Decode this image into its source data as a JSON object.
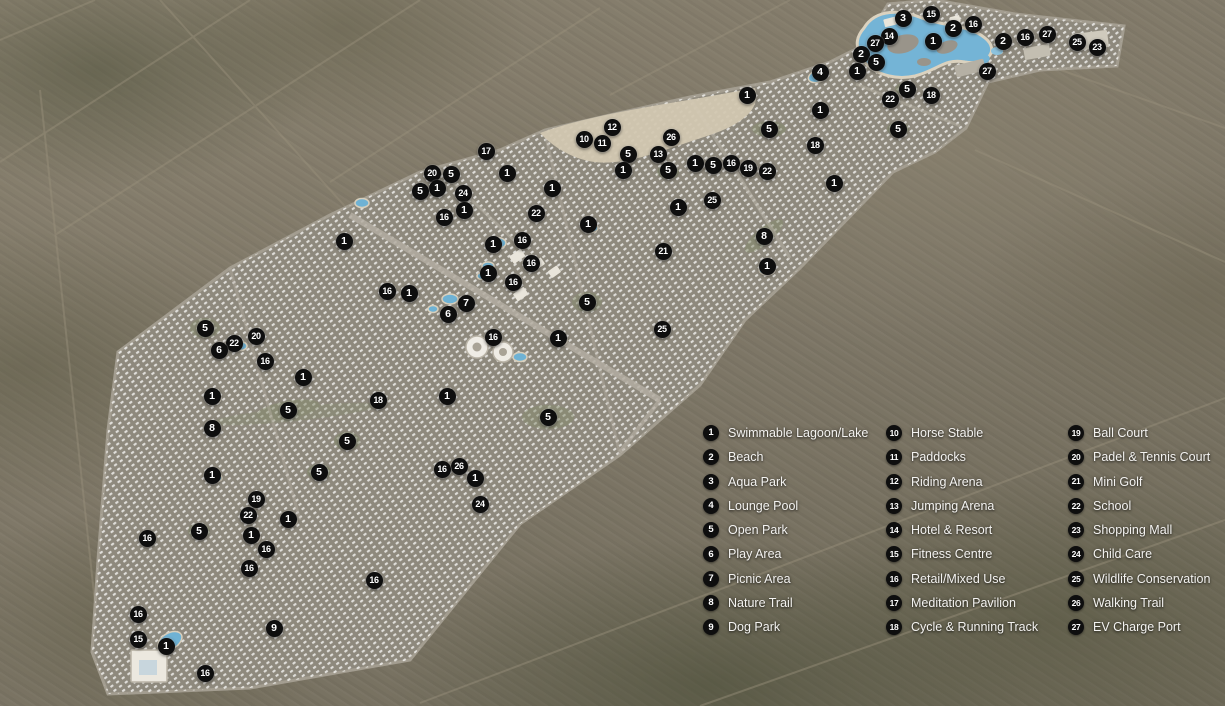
{
  "theme": {
    "marker_bg": "#0e0e0e",
    "marker_text": "#ffffff",
    "lagoon_blue": "#74b4d6",
    "sand_beige": "#d2c7b1",
    "site_gray": "#8e897d",
    "desert_brown": "#827a69"
  },
  "legend": {
    "columns": [
      {
        "items": [
          {
            "num": "1",
            "label": "Swimmable Lagoon/Lake"
          },
          {
            "num": "2",
            "label": "Beach"
          },
          {
            "num": "3",
            "label": "Aqua Park"
          },
          {
            "num": "4",
            "label": "Lounge Pool"
          },
          {
            "num": "5",
            "label": "Open Park"
          },
          {
            "num": "6",
            "label": "Play Area"
          },
          {
            "num": "7",
            "label": "Picnic Area"
          },
          {
            "num": "8",
            "label": "Nature Trail"
          },
          {
            "num": "9",
            "label": "Dog Park"
          }
        ]
      },
      {
        "items": [
          {
            "num": "10",
            "label": "Horse Stable"
          },
          {
            "num": "11",
            "label": "Paddocks"
          },
          {
            "num": "12",
            "label": "Riding Arena"
          },
          {
            "num": "13",
            "label": "Jumping Arena"
          },
          {
            "num": "14",
            "label": "Hotel & Resort"
          },
          {
            "num": "15",
            "label": "Fitness Centre"
          },
          {
            "num": "16",
            "label": "Retail/Mixed Use"
          },
          {
            "num": "17",
            "label": "Meditation Pavilion"
          },
          {
            "num": "18",
            "label": "Cycle & Running Track"
          }
        ]
      },
      {
        "items": [
          {
            "num": "19",
            "label": "Ball Court"
          },
          {
            "num": "20",
            "label": "Padel & Tennis Court"
          },
          {
            "num": "21",
            "label": "Mini Golf"
          },
          {
            "num": "22",
            "label": "School"
          },
          {
            "num": "23",
            "label": "Shopping Mall"
          },
          {
            "num": "24",
            "label": "Child Care"
          },
          {
            "num": "25",
            "label": "Wildlife Conservation"
          },
          {
            "num": "26",
            "label": "Walking Trail"
          },
          {
            "num": "27",
            "label": "EV Charge Port"
          }
        ]
      }
    ]
  },
  "map": {
    "markers": [
      {
        "n": "15",
        "x": 931,
        "y": 14
      },
      {
        "n": "3",
        "x": 903,
        "y": 18
      },
      {
        "n": "16",
        "x": 973,
        "y": 24
      },
      {
        "n": "2",
        "x": 953,
        "y": 28
      },
      {
        "n": "27",
        "x": 1047,
        "y": 34
      },
      {
        "n": "14",
        "x": 889,
        "y": 36
      },
      {
        "n": "16",
        "x": 1025,
        "y": 37
      },
      {
        "n": "1",
        "x": 933,
        "y": 41
      },
      {
        "n": "2",
        "x": 1003,
        "y": 41
      },
      {
        "n": "25",
        "x": 1077,
        "y": 42
      },
      {
        "n": "27",
        "x": 875,
        "y": 43
      },
      {
        "n": "23",
        "x": 1097,
        "y": 47
      },
      {
        "n": "2",
        "x": 861,
        "y": 54
      },
      {
        "n": "5",
        "x": 876,
        "y": 62
      },
      {
        "n": "1",
        "x": 857,
        "y": 71
      },
      {
        "n": "4",
        "x": 820,
        "y": 72
      },
      {
        "n": "27",
        "x": 987,
        "y": 71
      },
      {
        "n": "5",
        "x": 907,
        "y": 89
      },
      {
        "n": "18",
        "x": 931,
        "y": 95
      },
      {
        "n": "1",
        "x": 747,
        "y": 95
      },
      {
        "n": "22",
        "x": 890,
        "y": 99
      },
      {
        "n": "1",
        "x": 820,
        "y": 110
      },
      {
        "n": "12",
        "x": 612,
        "y": 127
      },
      {
        "n": "5",
        "x": 769,
        "y": 129
      },
      {
        "n": "5",
        "x": 898,
        "y": 129
      },
      {
        "n": "26",
        "x": 671,
        "y": 137
      },
      {
        "n": "10",
        "x": 584,
        "y": 139
      },
      {
        "n": "11",
        "x": 602,
        "y": 143
      },
      {
        "n": "18",
        "x": 815,
        "y": 145
      },
      {
        "n": "17",
        "x": 486,
        "y": 151
      },
      {
        "n": "5",
        "x": 628,
        "y": 154
      },
      {
        "n": "13",
        "x": 658,
        "y": 154
      },
      {
        "n": "1",
        "x": 695,
        "y": 163
      },
      {
        "n": "16",
        "x": 731,
        "y": 163
      },
      {
        "n": "5",
        "x": 713,
        "y": 165
      },
      {
        "n": "19",
        "x": 748,
        "y": 168
      },
      {
        "n": "1",
        "x": 623,
        "y": 170
      },
      {
        "n": "5",
        "x": 668,
        "y": 170
      },
      {
        "n": "22",
        "x": 767,
        "y": 171
      },
      {
        "n": "20",
        "x": 432,
        "y": 173
      },
      {
        "n": "1",
        "x": 507,
        "y": 173
      },
      {
        "n": "5",
        "x": 451,
        "y": 174
      },
      {
        "n": "1",
        "x": 834,
        "y": 183
      },
      {
        "n": "1",
        "x": 437,
        "y": 188
      },
      {
        "n": "1",
        "x": 552,
        "y": 188
      },
      {
        "n": "5",
        "x": 420,
        "y": 191
      },
      {
        "n": "24",
        "x": 463,
        "y": 193
      },
      {
        "n": "25",
        "x": 712,
        "y": 200
      },
      {
        "n": "1",
        "x": 678,
        "y": 207
      },
      {
        "n": "1",
        "x": 464,
        "y": 210
      },
      {
        "n": "22",
        "x": 536,
        "y": 213
      },
      {
        "n": "16",
        "x": 444,
        "y": 217
      },
      {
        "n": "1",
        "x": 588,
        "y": 224
      },
      {
        "n": "8",
        "x": 764,
        "y": 236
      },
      {
        "n": "16",
        "x": 522,
        "y": 240
      },
      {
        "n": "1",
        "x": 344,
        "y": 241
      },
      {
        "n": "1",
        "x": 493,
        "y": 244
      },
      {
        "n": "21",
        "x": 663,
        "y": 251
      },
      {
        "n": "16",
        "x": 531,
        "y": 263
      },
      {
        "n": "1",
        "x": 767,
        "y": 266
      },
      {
        "n": "1",
        "x": 488,
        "y": 273
      },
      {
        "n": "16",
        "x": 513,
        "y": 282
      },
      {
        "n": "16",
        "x": 387,
        "y": 291
      },
      {
        "n": "1",
        "x": 409,
        "y": 293
      },
      {
        "n": "5",
        "x": 587,
        "y": 302
      },
      {
        "n": "7",
        "x": 466,
        "y": 303
      },
      {
        "n": "6",
        "x": 448,
        "y": 314
      },
      {
        "n": "5",
        "x": 205,
        "y": 328
      },
      {
        "n": "25",
        "x": 662,
        "y": 329
      },
      {
        "n": "20",
        "x": 256,
        "y": 336
      },
      {
        "n": "16",
        "x": 493,
        "y": 337
      },
      {
        "n": "1",
        "x": 558,
        "y": 338
      },
      {
        "n": "22",
        "x": 234,
        "y": 343
      },
      {
        "n": "6",
        "x": 219,
        "y": 350
      },
      {
        "n": "16",
        "x": 265,
        "y": 361
      },
      {
        "n": "1",
        "x": 303,
        "y": 377
      },
      {
        "n": "1",
        "x": 212,
        "y": 396
      },
      {
        "n": "1",
        "x": 447,
        "y": 396
      },
      {
        "n": "18",
        "x": 378,
        "y": 400
      },
      {
        "n": "5",
        "x": 288,
        "y": 410
      },
      {
        "n": "5",
        "x": 548,
        "y": 417
      },
      {
        "n": "8",
        "x": 212,
        "y": 428
      },
      {
        "n": "5",
        "x": 347,
        "y": 441
      },
      {
        "n": "26",
        "x": 459,
        "y": 466
      },
      {
        "n": "16",
        "x": 442,
        "y": 469
      },
      {
        "n": "5",
        "x": 319,
        "y": 472
      },
      {
        "n": "1",
        "x": 212,
        "y": 475
      },
      {
        "n": "1",
        "x": 475,
        "y": 478
      },
      {
        "n": "19",
        "x": 256,
        "y": 499
      },
      {
        "n": "24",
        "x": 480,
        "y": 504
      },
      {
        "n": "22",
        "x": 248,
        "y": 515
      },
      {
        "n": "1",
        "x": 288,
        "y": 519
      },
      {
        "n": "5",
        "x": 199,
        "y": 531
      },
      {
        "n": "1",
        "x": 251,
        "y": 535
      },
      {
        "n": "16",
        "x": 147,
        "y": 538
      },
      {
        "n": "16",
        "x": 266,
        "y": 549
      },
      {
        "n": "16",
        "x": 249,
        "y": 568
      },
      {
        "n": "16",
        "x": 374,
        "y": 580
      },
      {
        "n": "16",
        "x": 138,
        "y": 614
      },
      {
        "n": "9",
        "x": 274,
        "y": 628
      },
      {
        "n": "15",
        "x": 138,
        "y": 639
      },
      {
        "n": "1",
        "x": 166,
        "y": 646
      },
      {
        "n": "16",
        "x": 205,
        "y": 673
      }
    ]
  }
}
